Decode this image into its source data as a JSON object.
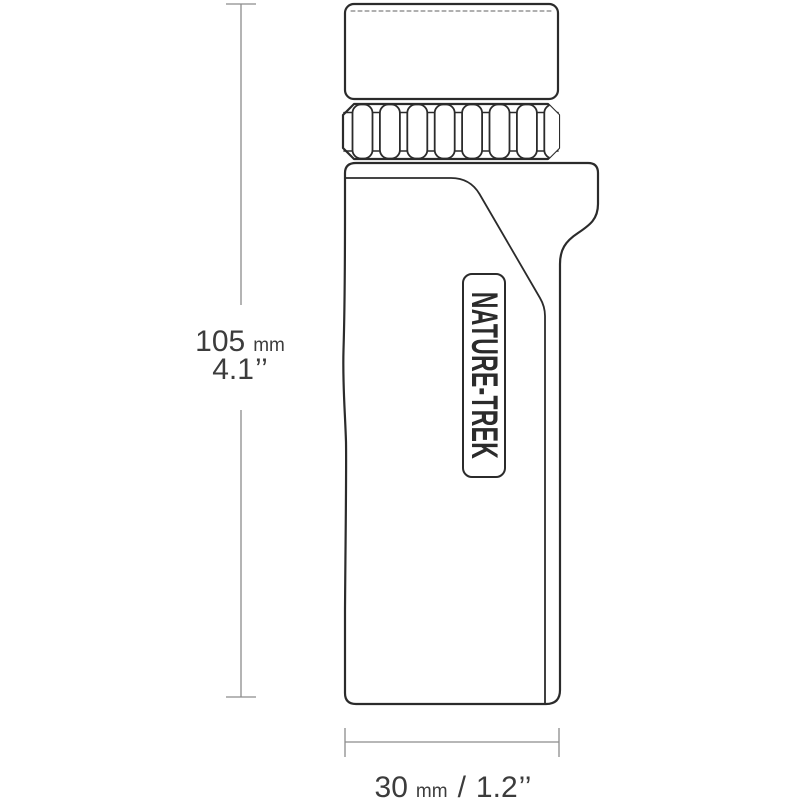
{
  "product": {
    "label": "NATURE-TREK"
  },
  "dimensions": {
    "height": {
      "value_mm": "105",
      "unit_mm": "mm",
      "value_in": "4.1",
      "unit_in": "’’"
    },
    "width": {
      "value_mm": "30",
      "unit_mm": "mm",
      "separator": "/",
      "value_in": "1.2",
      "unit_in": "’’"
    }
  },
  "colors": {
    "background": "#ffffff",
    "outline": "#2b2b2b",
    "dashed_line": "#606060",
    "dimension_line": "#8c8c8c",
    "text": "#3c3c3c"
  }
}
